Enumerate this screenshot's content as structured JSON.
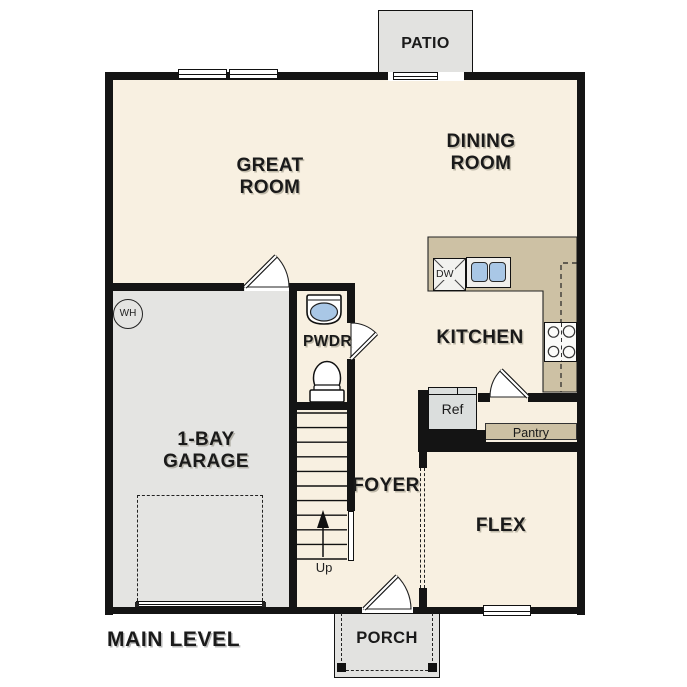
{
  "colors": {
    "floor": "#f8f0e1",
    "garage": "#e4e4e2",
    "outdoor": "#e2e2e0",
    "counter": "#cdc1a4",
    "wall": "#141414",
    "fixture_blue": "#a9c7e6",
    "label": "#1a1a1a"
  },
  "plan": {
    "level_title": "MAIN LEVEL",
    "rooms": {
      "great_room": {
        "line1": "GREAT",
        "line2": "ROOM"
      },
      "dining_room": {
        "line1": "DINING",
        "line2": "ROOM"
      },
      "kitchen": {
        "label": "KITCHEN"
      },
      "garage": {
        "line1": "1-BAY",
        "line2": "GARAGE"
      },
      "foyer": {
        "label": "FOYER"
      },
      "flex": {
        "label": "FLEX"
      },
      "powder": {
        "label": "PWDR"
      },
      "patio": {
        "label": "PATIO"
      },
      "porch": {
        "label": "PORCH"
      }
    },
    "fixtures": {
      "dishwasher": "DW",
      "refrigerator": "Ref",
      "pantry": "Pantry",
      "water_heater": "WH",
      "stairs_up": "Up"
    }
  }
}
